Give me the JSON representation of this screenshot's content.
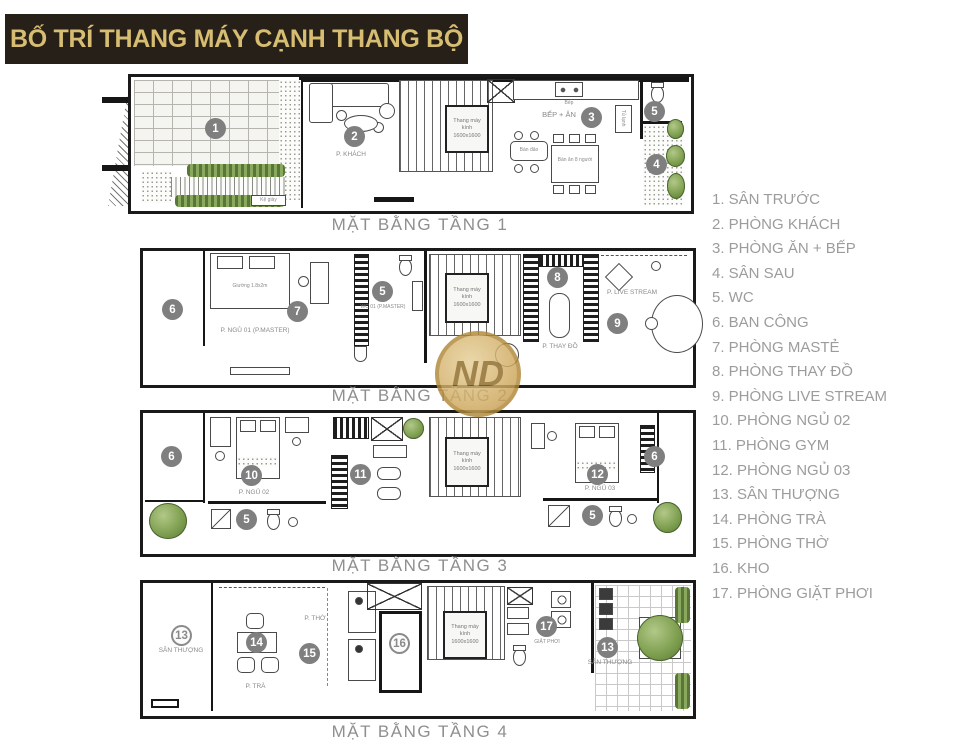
{
  "title": "BỐ TRÍ THANG MÁY CẠNH THANG BỘ",
  "watermark": {
    "text": "ND"
  },
  "colors": {
    "banner_bg": "#272018",
    "banner_text": "#d6bd72",
    "badge_gray": "#7f7f7f",
    "legend_text": "#9c9c9c",
    "plant_green": "#7fa050",
    "wall_black": "#161616"
  },
  "legend": {
    "items": [
      "1. SÂN TRƯỚC",
      "2. PHÒNG KHÁCH",
      "3. PHÒNG ĂN + BẾP",
      "4. SÂN SAU",
      "5. WC",
      "6. BAN CÔNG",
      "7. PHÒNG MASTẺ",
      "8. PHÒNG THAY ĐỒ",
      "9. PHÒNG LIVE STREAM",
      "10. PHÒNG NGỦ 02",
      "11. PHÒNG GYM",
      "12. PHÒNG NGỦ 03",
      "13. SÂN THƯỢNG",
      "14. PHÒNG TRÀ",
      "15. PHÒNG THỜ",
      "16. KHO",
      "17. PHÒNG GIẶT PHƠI"
    ]
  },
  "floors": [
    {
      "caption": "MẶT BẰNG TẦNG 1",
      "elevator": "Thang máy kính 1600x1600",
      "badges": {
        "front_yard": "1",
        "living": "2",
        "kitchen": "3",
        "backyard": "4",
        "wc": "5"
      },
      "labels": {
        "living": "P. KHÁCH",
        "kitchen": "BẾP + ĂN",
        "stove": "Bếp",
        "island": "Bàn đảo",
        "dining": "Bàn ăn 8 người",
        "fridge": "Tủ lạnh",
        "shoes": "Kệ giày"
      }
    },
    {
      "caption": "MẶT BẰNG TẦNG 2",
      "elevator": "Thang máy kính 1600x1600",
      "badges": {
        "balcony": "6",
        "master": "7",
        "wc": "5",
        "dressing": "8",
        "livestream": "9"
      },
      "labels": {
        "bed": "Giường 1.8x2m",
        "master": "P. NGỦ 01 (P.MASTER)",
        "wc": "WC 01 (P.MASTER)",
        "dressing": "P. THAY ĐỒ",
        "livestream": "P. LIVE STREAM"
      }
    },
    {
      "caption": "MẶT BẰNG TẦNG 3",
      "elevator": "Thang máy kính 1600x1600",
      "badges": {
        "balcony_left": "6",
        "bedroom2": "10",
        "wc_left": "5",
        "gym": "11",
        "bedroom3": "12",
        "wc_right": "5",
        "balcony_right": "6"
      },
      "labels": {
        "bedroom2": "P. NGỦ 02",
        "bedroom3": "P. NGỦ 03"
      }
    },
    {
      "caption": "MẶT BẰNG TẦNG 4",
      "elevator": "Thang máy kính 1600x1600",
      "badges": {
        "terrace_left": "13",
        "tea": "14",
        "worship": "15",
        "storage": "16",
        "laundry": "17",
        "terrace_right": "13"
      },
      "labels": {
        "terrace_left": "SÂN THƯỢNG",
        "tea": "P. TRÀ",
        "worship": "P. THỜ",
        "laundry": "GIẶT PHƠI",
        "terrace_right": "SÂN THƯỢNG"
      }
    }
  ]
}
